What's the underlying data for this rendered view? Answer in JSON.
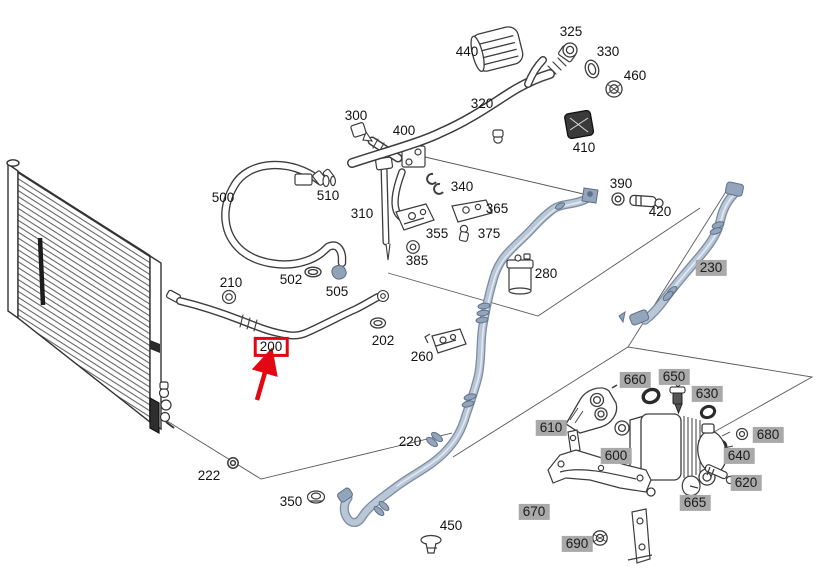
{
  "diagram": {
    "kind": "vehicle-parts-exploded-diagram",
    "selection": {
      "ref": "200",
      "style": "red-box-with-red-arrow"
    }
  },
  "colors": {
    "highlight_red": "#e30613",
    "badge_gray": "#a9a9a9",
    "pipe_fill": "#b9c6d6",
    "pipe_shade": "#7b8da3",
    "pipe_sheen": "#e2e8f0",
    "line_art": "#3d3d3d",
    "guide_line": "#5a5a5a"
  },
  "callouts": {
    "plain": [
      {
        "ref": "300",
        "x": 356,
        "y": 116
      },
      {
        "ref": "400",
        "x": 404,
        "y": 131
      },
      {
        "ref": "440",
        "x": 467,
        "y": 52
      },
      {
        "ref": "325",
        "x": 571,
        "y": 32
      },
      {
        "ref": "330",
        "x": 608,
        "y": 52
      },
      {
        "ref": "460",
        "x": 635,
        "y": 76
      },
      {
        "ref": "320",
        "x": 482,
        "y": 104
      },
      {
        "ref": "410",
        "x": 584,
        "y": 148
      },
      {
        "ref": "390",
        "x": 621,
        "y": 184
      },
      {
        "ref": "420",
        "x": 660,
        "y": 212
      },
      {
        "ref": "500",
        "x": 223,
        "y": 198
      },
      {
        "ref": "510",
        "x": 328,
        "y": 196
      },
      {
        "ref": "310",
        "x": 362,
        "y": 214
      },
      {
        "ref": "340",
        "x": 462,
        "y": 187
      },
      {
        "ref": "365",
        "x": 497,
        "y": 209
      },
      {
        "ref": "355",
        "x": 437,
        "y": 234
      },
      {
        "ref": "375",
        "x": 489,
        "y": 234
      },
      {
        "ref": "385",
        "x": 417,
        "y": 261
      },
      {
        "ref": "210",
        "x": 231,
        "y": 283
      },
      {
        "ref": "502",
        "x": 291,
        "y": 280
      },
      {
        "ref": "505",
        "x": 337,
        "y": 292
      },
      {
        "ref": "202",
        "x": 383,
        "y": 341
      },
      {
        "ref": "260",
        "x": 422,
        "y": 357
      },
      {
        "ref": "280",
        "x": 546,
        "y": 274
      },
      {
        "ref": "220",
        "x": 410,
        "y": 442
      },
      {
        "ref": "222",
        "x": 209,
        "y": 476
      },
      {
        "ref": "350",
        "x": 291,
        "y": 502
      },
      {
        "ref": "450",
        "x": 451,
        "y": 526
      }
    ],
    "shaded": [
      {
        "ref": "230",
        "x": 711,
        "y": 268
      },
      {
        "ref": "660",
        "x": 635,
        "y": 380
      },
      {
        "ref": "650",
        "x": 674,
        "y": 377
      },
      {
        "ref": "630",
        "x": 707,
        "y": 394
      },
      {
        "ref": "610",
        "x": 551,
        "y": 428
      },
      {
        "ref": "600",
        "x": 616,
        "y": 456
      },
      {
        "ref": "680",
        "x": 768,
        "y": 435
      },
      {
        "ref": "640",
        "x": 739,
        "y": 456
      },
      {
        "ref": "620",
        "x": 746,
        "y": 483
      },
      {
        "ref": "665",
        "x": 695,
        "y": 503
      },
      {
        "ref": "670",
        "x": 534,
        "y": 512
      },
      {
        "ref": "690",
        "x": 577,
        "y": 544
      }
    ],
    "selected": {
      "ref": "200",
      "x": 271,
      "y": 347
    }
  }
}
